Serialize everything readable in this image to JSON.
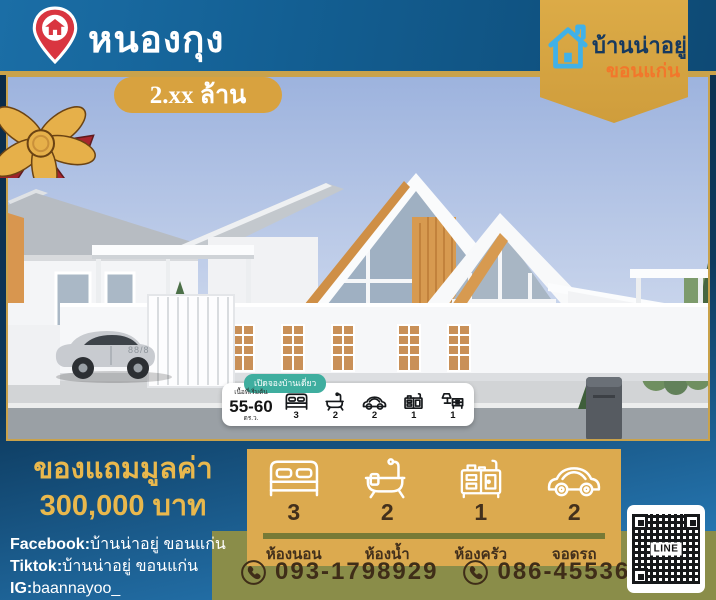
{
  "colors": {
    "header_blue": "#135f93",
    "gold_line": "#c9a24b",
    "badge_gold": "#d8a23f",
    "banner_gold": "#dcab47",
    "brand_navy": "#16395f",
    "brand_orange": "#f2772b",
    "house_blue": "#41b1e8",
    "pin_red": "#d93540",
    "footer_navy": "#0a2742",
    "giveaway_gold": "#e9b84d",
    "panel_gold": "#dcaa4f",
    "olive": "#8a8d49",
    "brown_text": "#43301c",
    "teal_pill": "#3fae9f",
    "accent_wood": "#d79a50"
  },
  "header": {
    "location": "หนองกุง",
    "price_badge": "2.xx ล้าน"
  },
  "brand": {
    "name": "บ้านน่าอยู่",
    "city": "ขอนแก่น"
  },
  "photo": {
    "house_number": "88/8",
    "info_card": {
      "pill": "เปิดจองบ้านเดี่ยว",
      "area_label": "เนื้อที่เริ่มต้น",
      "area_value": "55-60",
      "area_unit": "ตร.ว.",
      "items": [
        {
          "icon": "bed-icon",
          "count": "3"
        },
        {
          "icon": "bathtub-icon",
          "count": "2"
        },
        {
          "icon": "car-icon",
          "count": "2"
        },
        {
          "icon": "kitchen-icon",
          "count": "1"
        },
        {
          "icon": "furniture-icon",
          "count": "1"
        }
      ]
    }
  },
  "footer": {
    "giveaway": {
      "line1": "ของแถมมูลค่า",
      "line2": "300,000 บาท"
    },
    "contacts": [
      {
        "label": "Facebook:",
        "value": "บ้านน่าอยู่ ขอนแก่น"
      },
      {
        "label": "Tiktok:",
        "value": "บ้านน่าอยู่ ขอนแก่น"
      },
      {
        "label": "IG:",
        "value": "baannayoo_"
      }
    ],
    "amenities": [
      {
        "icon": "bed-icon",
        "count": "3",
        "label": "ห้องนอน"
      },
      {
        "icon": "bathtub-icon",
        "count": "2",
        "label": "ห้องน้ำ"
      },
      {
        "icon": "kitchen-icon",
        "count": "1",
        "label": "ห้องครัว"
      },
      {
        "icon": "car-icon",
        "count": "2",
        "label": "จอดรถ"
      }
    ],
    "phones": [
      {
        "icon": "phone-icon",
        "number": "093-1798929"
      },
      {
        "icon": "phone-icon",
        "number": "086-4553695"
      }
    ],
    "qr_label": "LINE"
  }
}
